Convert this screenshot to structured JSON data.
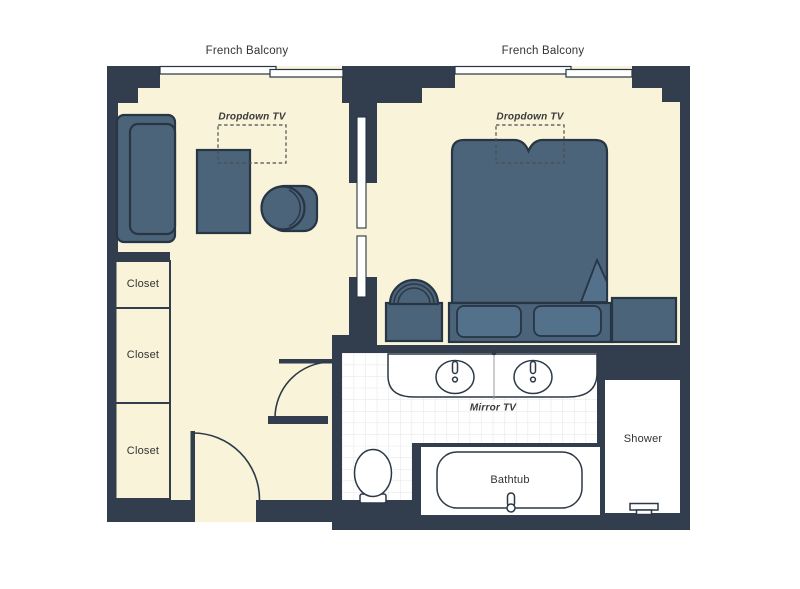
{
  "title": "Suite floor plan",
  "labels": {
    "balcony_living": "French Balcony",
    "balcony_bedroom": "French Balcony",
    "tv_living": "Dropdown TV",
    "tv_bedroom": "Dropdown TV",
    "closet_1": "Closet",
    "closet_2": "Closet",
    "closet_3": "Closet",
    "mirror_tv": "Mirror TV",
    "bathtub": "Bathtub",
    "shower": "Shower"
  },
  "colors": {
    "wall": "#323e4d",
    "floor": "#f8f3d9",
    "furniture": "#4b6479",
    "furniture_light": "#54718c",
    "fixture": "#ffffff",
    "tile_grid": "#e4e4e4",
    "label_text": "#333333"
  }
}
